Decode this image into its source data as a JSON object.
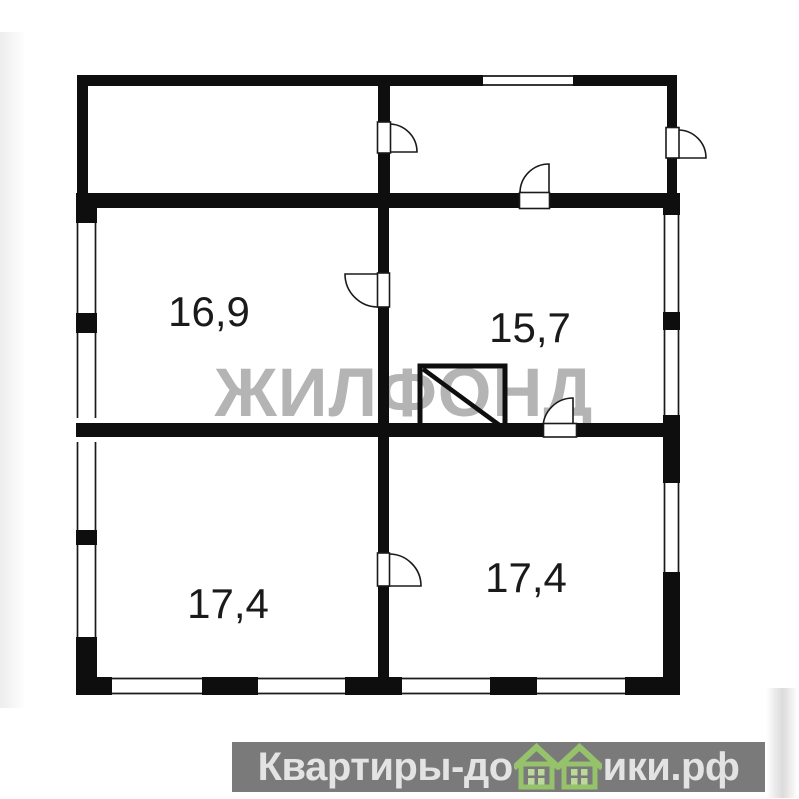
{
  "plan": {
    "watermark": "ЖИЛФОНД",
    "rooms": [
      {
        "id": "room-top-left",
        "area_label": "16,9"
      },
      {
        "id": "room-top-right",
        "area_label": "15,7"
      },
      {
        "id": "room-bottom-left",
        "area_label": "17,4"
      },
      {
        "id": "room-bottom-right",
        "area_label": "17,4"
      }
    ],
    "symbols": {
      "stove": "stove-square-with-diagonal",
      "doors": 6,
      "windows": 8
    },
    "colors": {
      "wall": "#0e0e0e",
      "watermark_gray": "#b4b4b4",
      "label_color": "#1a1a1a"
    }
  },
  "footer": {
    "brand_full": "Квартиры-домики.рф",
    "brand_prefix": "Квартиры-до",
    "brand_suffix": "ики.рф",
    "bar_bg": "#7a7a7a",
    "text_color": "#e3e3e3",
    "house_green": "#95c26a"
  }
}
